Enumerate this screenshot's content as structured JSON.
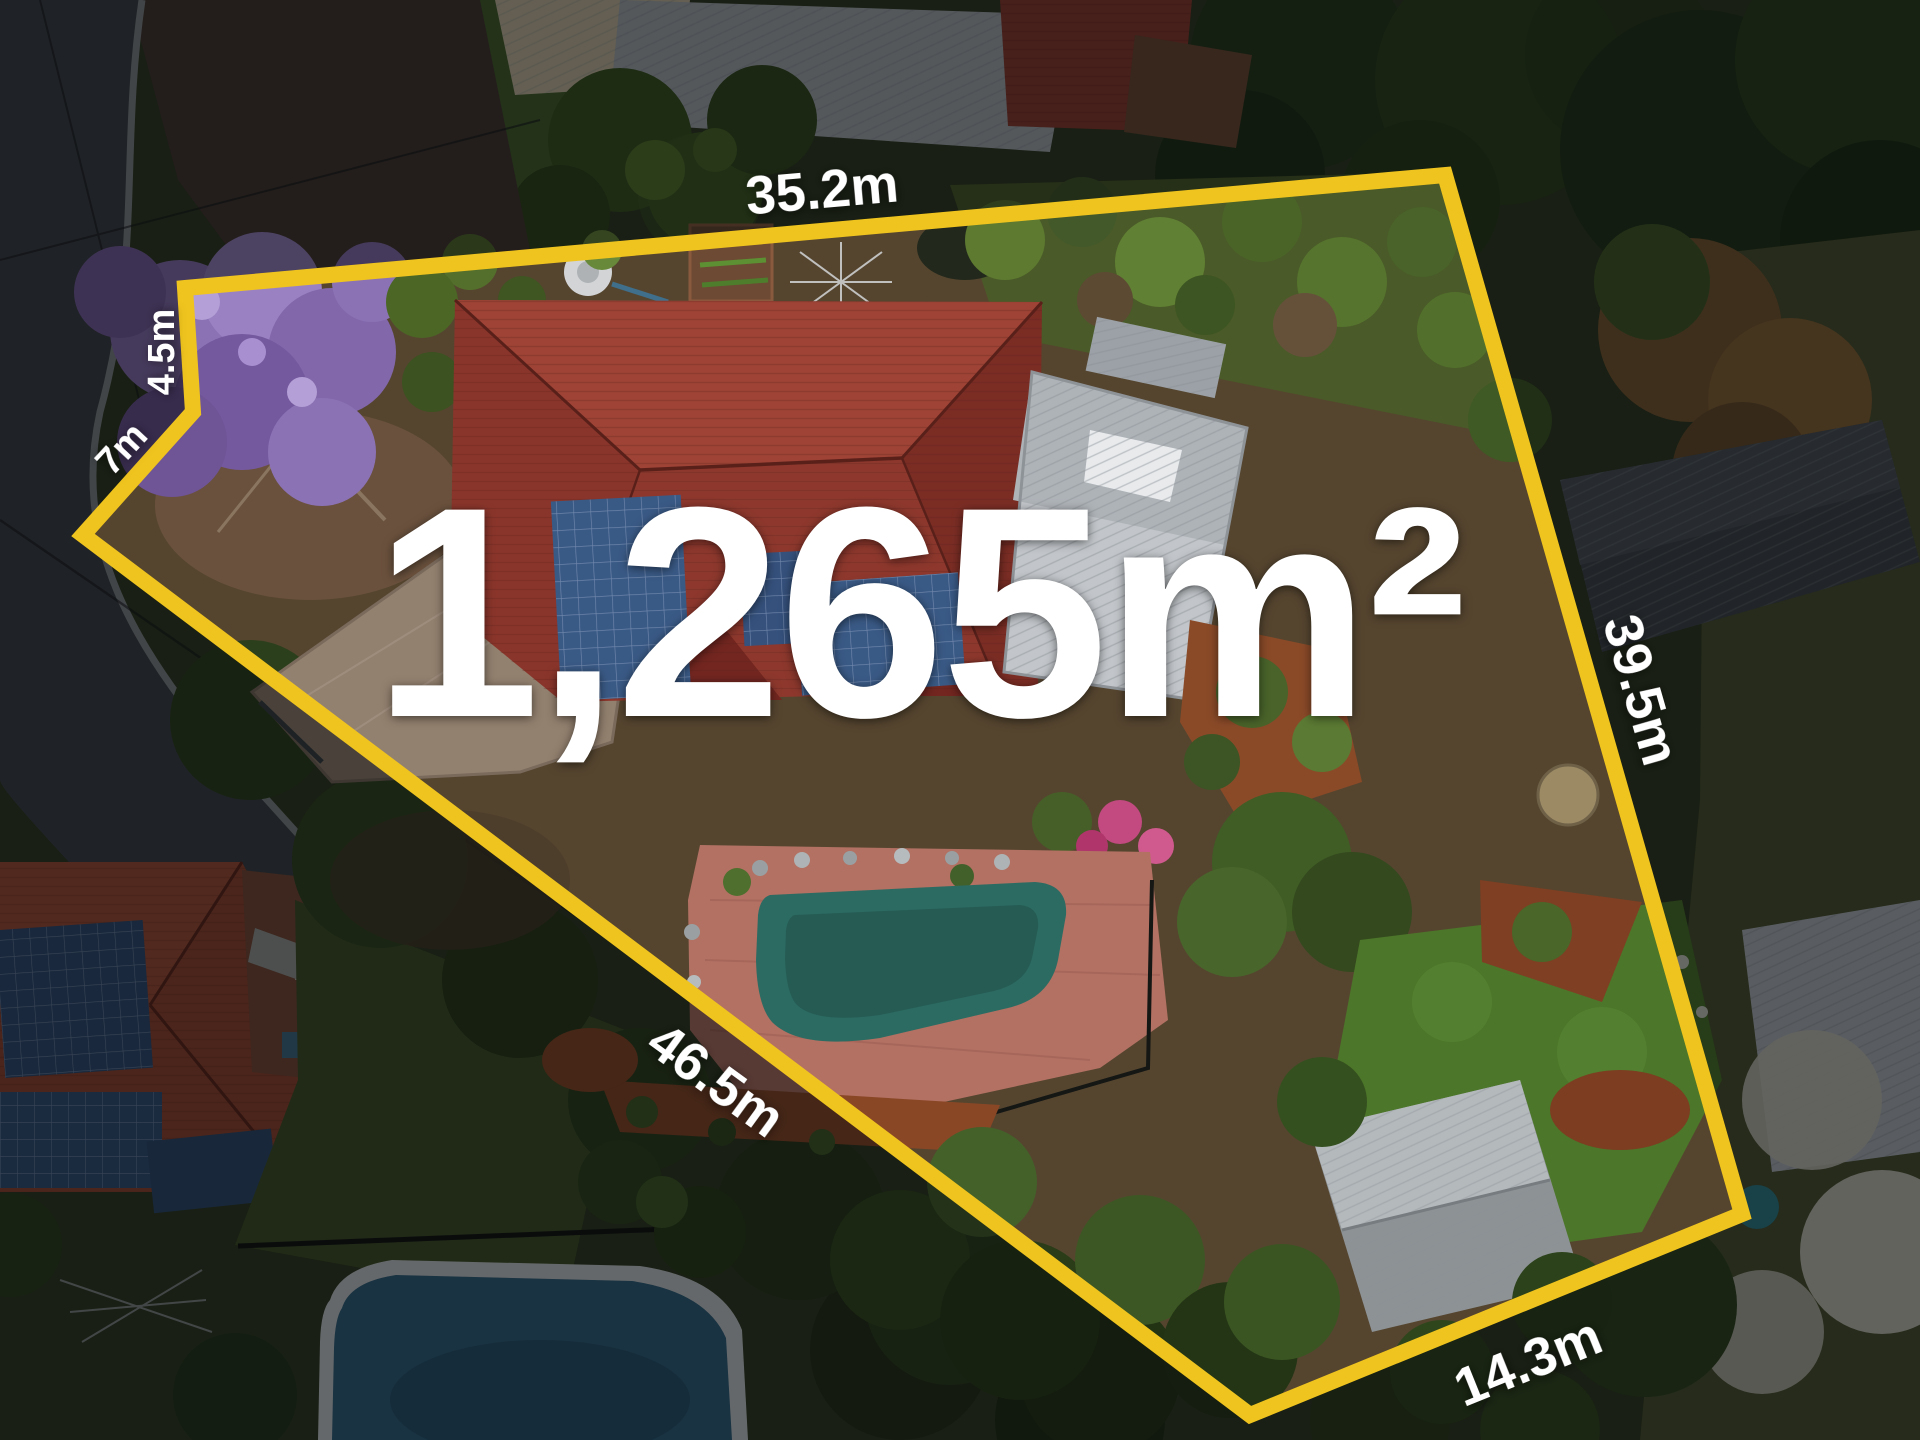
{
  "overlay": {
    "area_label": "1,265m²",
    "boundary_color": "#F0C41E",
    "label_color": "#FFFFFF",
    "sides": [
      {
        "side": "top",
        "label": "35.2m"
      },
      {
        "side": "left-upper",
        "label": "4.5m"
      },
      {
        "side": "left-lower",
        "label": "7m"
      },
      {
        "side": "right",
        "label": "39.5m"
      },
      {
        "side": "bottom-left",
        "label": "46.5m"
      },
      {
        "side": "bottom-right",
        "label": "14.3m"
      }
    ]
  }
}
